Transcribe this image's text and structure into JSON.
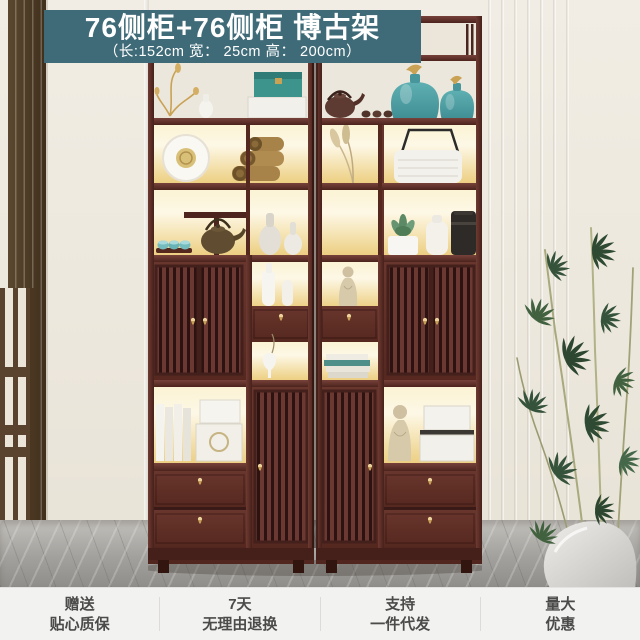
{
  "banner": {
    "title": "76侧柜+76侧柜 博古架",
    "dimensions": "（长:152cm 宽： 25cm 高： 200cm）"
  },
  "footer": {
    "items": [
      {
        "line1": "赠送",
        "line2": "贴心质保"
      },
      {
        "line1": "7天",
        "line2": "无理由退换"
      },
      {
        "line1": "支持",
        "line2": "一件代发"
      },
      {
        "line1": "量大",
        "line2": "优惠"
      }
    ]
  },
  "colors": {
    "banner_bg": "#3f6b78",
    "banner_text": "#ffffff",
    "wood": "#5e2f29",
    "wood_dark": "#3a1a16",
    "brass": "#c79e55",
    "glow_warm": "#f0d28a",
    "teal_accent": "#4fa0a6",
    "wall": "#ece7dc",
    "floor_gray": "#a3a19d",
    "footer_bg": "#f2f2f0",
    "footer_text": "#4b4b4a",
    "footer_divider": "#dcdbd9"
  }
}
